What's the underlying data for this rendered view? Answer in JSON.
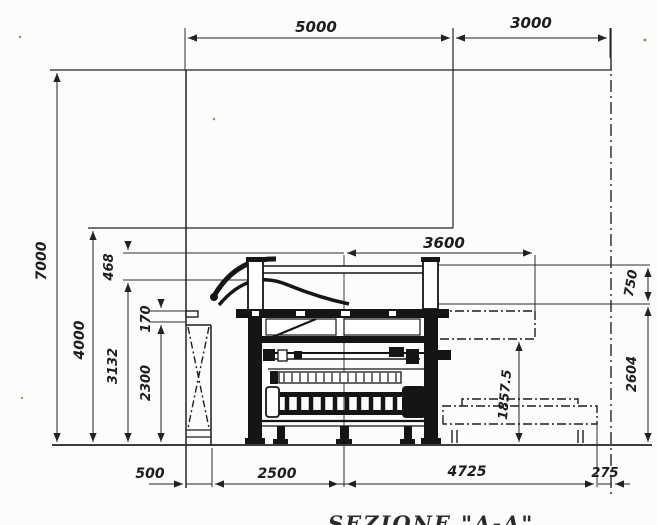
{
  "drawing": {
    "caption": "SEZIONE \"A-A\"",
    "colors": {
      "ink": "#1f1f1f",
      "paper": "#fcfcfa"
    },
    "dimensions": {
      "horizontal_top": {
        "d5000": "5000",
        "d3000": "3000"
      },
      "vertical_left": {
        "d7000": "7000",
        "d4000": "4000",
        "d468": "468",
        "d3132": "3132",
        "d170": "170",
        "d2300": "2300"
      },
      "machine": {
        "d3600": "3600"
      },
      "vertical_right": {
        "d750": "750",
        "d2604": "2604",
        "d1857_5": "1857.5"
      },
      "horizontal_bottom": {
        "d500": "500",
        "d2500": "2500",
        "d4725": "4725",
        "d275": "275"
      }
    }
  }
}
